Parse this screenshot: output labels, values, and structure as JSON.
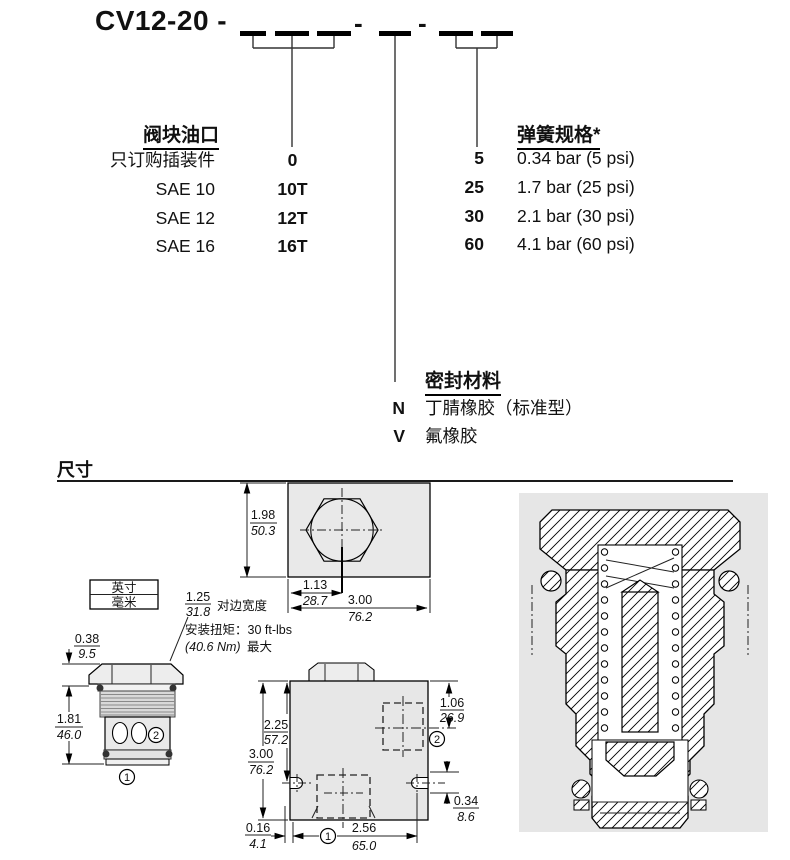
{
  "colors": {
    "panel_gray": "#e6e6e6",
    "block_gray": "#e7e7e7",
    "thread_gray": "#d9d9d9",
    "line_black": "#000000"
  },
  "ordering": {
    "model_prefix": "CV12-20 -",
    "separator1": "-",
    "separator2": "-",
    "port_table": {
      "heading": "阀块油口",
      "rows": [
        {
          "label": "只订购插装件",
          "code": "0"
        },
        {
          "label": "SAE 10",
          "code": "10T"
        },
        {
          "label": "SAE 12",
          "code": "12T"
        },
        {
          "label": "SAE 16",
          "code": "16T"
        }
      ]
    },
    "spring_table": {
      "heading": "弹簧规格*",
      "rows": [
        {
          "code": "5",
          "label": "0.34 bar (5 psi)"
        },
        {
          "code": "25",
          "label": "1.7 bar (25 psi)"
        },
        {
          "code": "30",
          "label": "2.1 bar (30 psi)"
        },
        {
          "code": "60",
          "label": "4.1 bar (60 psi)"
        }
      ]
    },
    "seal_table": {
      "heading": "密封材料",
      "rows": [
        {
          "code": "N",
          "label": "丁腈橡胶（标准型）"
        },
        {
          "code": "V",
          "label": "氟橡胶"
        }
      ]
    }
  },
  "dims": {
    "section_heading": "尺寸",
    "legend_top": "英寸",
    "legend_bottom": "毫米",
    "across_flats_inch": "1.25",
    "across_flats_mm": "31.8",
    "across_flats_note": "对边宽度",
    "torque_line1": "安装扭矩：30 ft-lbs",
    "torque_value": "(40.6 Nm)",
    "torque_max": "最大",
    "topview": {
      "h_in": "1.98",
      "h_mm": "50.3",
      "c_in": "1.13",
      "c_mm": "28.7",
      "w_in": "3.00",
      "w_mm": "76.2"
    },
    "cartridge": {
      "head_in": "0.38",
      "head_mm": "9.5",
      "len_in": "1.81",
      "len_mm": "46.0",
      "port1": "1",
      "port2": "2"
    },
    "block": {
      "p2_in": "1.06",
      "p2_mm": "26.9",
      "a_in": "2.25",
      "a_mm": "57.2",
      "h_in": "3.00",
      "h_mm": "76.2",
      "e_in": "0.16",
      "e_mm": "4.1",
      "w_in": "2.56",
      "w_mm": "65.0",
      "s_in": "0.34",
      "s_mm": "8.6",
      "port1": "1",
      "port2": "2"
    }
  }
}
